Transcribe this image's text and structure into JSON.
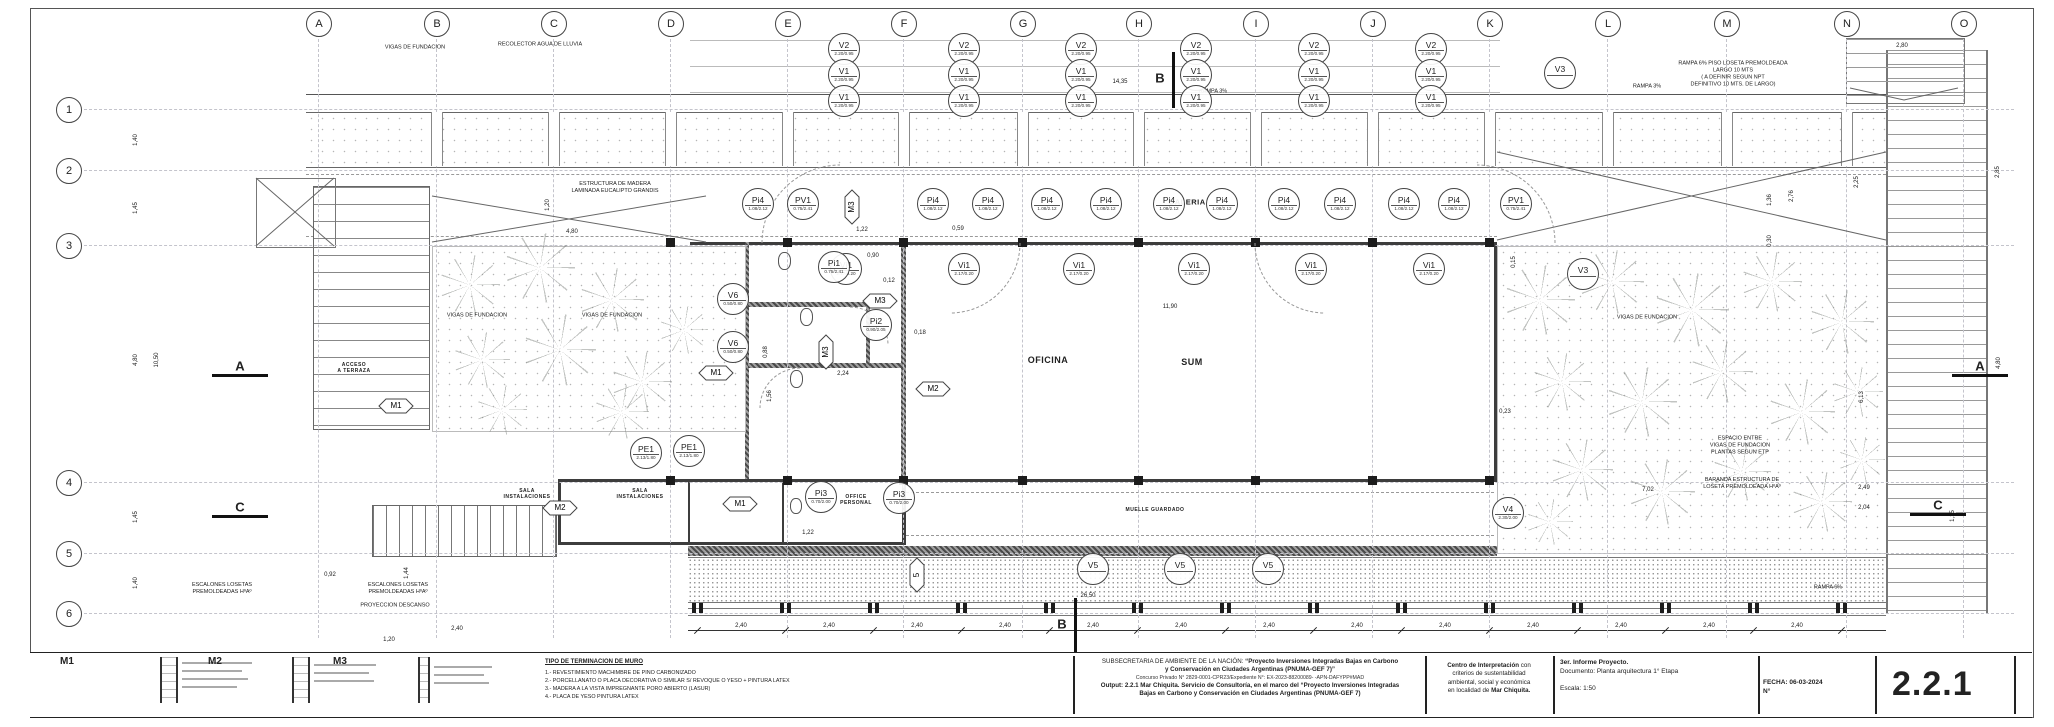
{
  "sheet": {
    "number": "2.2.1"
  },
  "grid": {
    "letters": [
      {
        "label": "A",
        "x": 318
      },
      {
        "label": "B",
        "x": 436
      },
      {
        "label": "C",
        "x": 553
      },
      {
        "label": "D",
        "x": 670
      },
      {
        "label": "E",
        "x": 787
      },
      {
        "label": "F",
        "x": 903
      },
      {
        "label": "G",
        "x": 1022
      },
      {
        "label": "H",
        "x": 1138
      },
      {
        "label": "I",
        "x": 1255
      },
      {
        "label": "J",
        "x": 1372
      },
      {
        "label": "K",
        "x": 1489
      },
      {
        "label": "L",
        "x": 1607
      },
      {
        "label": "M",
        "x": 1726
      },
      {
        "label": "N",
        "x": 1846
      },
      {
        "label": "O",
        "x": 1963
      }
    ],
    "numbers": [
      {
        "label": "1",
        "y": 109
      },
      {
        "label": "2",
        "y": 170
      },
      {
        "label": "3",
        "y": 245
      },
      {
        "label": "4",
        "y": 482
      },
      {
        "label": "5",
        "y": 553
      },
      {
        "label": "6",
        "y": 613
      }
    ]
  },
  "rooms": [
    {
      "label": "OFICINA",
      "x": 1048,
      "y": 360,
      "size": 9
    },
    {
      "label": "SUM",
      "x": 1192,
      "y": 362,
      "size": 9
    },
    {
      "label": "GALERIA",
      "x": 1187,
      "y": 202,
      "size": 7.5
    },
    {
      "label": "SALA\nINSTALACIONES",
      "x": 527,
      "y": 494,
      "size": 5
    },
    {
      "label": "SALA\nINSTALACIONES",
      "x": 640,
      "y": 494,
      "size": 5
    },
    {
      "label": "OFFICE\nPERSONAL",
      "x": 856,
      "y": 500,
      "size": 5
    },
    {
      "label": "ACCESO\nA TERRAZA",
      "x": 354,
      "y": 368,
      "size": 5
    },
    {
      "label": "MUELLE GUARDADO",
      "x": 1155,
      "y": 510,
      "size": 5
    }
  ],
  "annotations": [
    {
      "x": 415,
      "y": 48,
      "lines": [
        "VIGAS DE FUNDACION"
      ]
    },
    {
      "x": 540,
      "y": 45,
      "lines": [
        "RECOLECTOR AGUA DE LLUVIA"
      ]
    },
    {
      "x": 1213,
      "y": 92,
      "lines": [
        "RAMPA 3%"
      ]
    },
    {
      "x": 1647,
      "y": 87,
      "lines": [
        "RAMPA 3%"
      ]
    },
    {
      "x": 1733,
      "y": 74,
      "lines": [
        "RAMPA 6% PISO LOSETA PREMOLDEADA",
        "LARGO 10 MTS",
        "( A DEFINIR SEGUN NPT",
        "DEFINITIVO 10 MTS. DE LARGO)"
      ]
    },
    {
      "x": 615,
      "y": 188,
      "lines": [
        "ESTRUCTURA DE MADERA",
        "LAMINADA EUCALIPTO GRANDIS"
      ]
    },
    {
      "x": 477,
      "y": 316,
      "lines": [
        "VIGAS DE FUNDACION"
      ]
    },
    {
      "x": 612,
      "y": 316,
      "lines": [
        "VIGAS DE FUNDACION"
      ]
    },
    {
      "x": 1647,
      "y": 318,
      "lines": [
        "VIGAS DE FUNDACION"
      ]
    },
    {
      "x": 1740,
      "y": 446,
      "lines": [
        "ESPACIO ENTRE",
        "VIGAS DE FUNDACION",
        "PLANTAS SEGUN ETP"
      ]
    },
    {
      "x": 1742,
      "y": 484,
      "lines": [
        "BARANDA ESTRUCTURA DE",
        "LOSETA PREMOLDEADA HºAº"
      ]
    },
    {
      "x": 222,
      "y": 589,
      "lines": [
        "ESCALONES LOSETAS",
        "PREMOLDEADAS HºAº"
      ]
    },
    {
      "x": 398,
      "y": 589,
      "lines": [
        "ESCALONES LOSETAS",
        "PREMOLDEADAS HºAº"
      ]
    },
    {
      "x": 395,
      "y": 606,
      "lines": [
        "PROYECCION DESCANSO"
      ]
    },
    {
      "x": 1828,
      "y": 588,
      "lines": [
        "RAMPA 6%"
      ]
    }
  ],
  "dimensions": [
    {
      "text": "33,60",
      "x": 1137,
      "y": 30
    },
    {
      "text": "14,35",
      "x": 1120,
      "y": 82
    },
    {
      "text": "2,80",
      "x": 1902,
      "y": 46
    },
    {
      "text": "1,40",
      "x": 136,
      "y": 140,
      "rot": "v"
    },
    {
      "text": "1,45",
      "x": 136,
      "y": 208,
      "rot": "v"
    },
    {
      "text": "4,80",
      "x": 136,
      "y": 360,
      "rot": "v"
    },
    {
      "text": "10,50",
      "x": 157,
      "y": 360,
      "rot": "v"
    },
    {
      "text": "1,45",
      "x": 136,
      "y": 517,
      "rot": "v"
    },
    {
      "text": "1,40",
      "x": 136,
      "y": 583,
      "rot": "v"
    },
    {
      "text": "4,80",
      "x": 572,
      "y": 232
    },
    {
      "text": "1,20",
      "x": 548,
      "y": 205,
      "rot": "v"
    },
    {
      "text": "11,90",
      "x": 1170,
      "y": 307
    },
    {
      "text": "0,90",
      "x": 873,
      "y": 256
    },
    {
      "text": "0,12",
      "x": 889,
      "y": 281
    },
    {
      "text": "0,88",
      "x": 766,
      "y": 352,
      "rot": "v"
    },
    {
      "text": "1,56",
      "x": 770,
      "y": 396,
      "rot": "v"
    },
    {
      "text": "2,24",
      "x": 843,
      "y": 374
    },
    {
      "text": "0,18",
      "x": 920,
      "y": 333
    },
    {
      "text": "1,22",
      "x": 862,
      "y": 230
    },
    {
      "text": "0,59",
      "x": 958,
      "y": 229
    },
    {
      "text": "0,15",
      "x": 1514,
      "y": 262,
      "rot": "v"
    },
    {
      "text": "1,22",
      "x": 808,
      "y": 533
    },
    {
      "text": "2,25",
      "x": 1857,
      "y": 182,
      "rot": "v"
    },
    {
      "text": "2,85",
      "x": 1998,
      "y": 172,
      "rot": "v"
    },
    {
      "text": "1,36",
      "x": 1770,
      "y": 200,
      "rot": "v"
    },
    {
      "text": "2,76",
      "x": 1792,
      "y": 196,
      "rot": "v"
    },
    {
      "text": "0,30",
      "x": 1770,
      "y": 241,
      "rot": "v"
    },
    {
      "text": "6,13",
      "x": 1862,
      "y": 397,
      "rot": "v"
    },
    {
      "text": "4,80",
      "x": 1999,
      "y": 363,
      "rot": "v"
    },
    {
      "text": "7,02",
      "x": 1648,
      "y": 490
    },
    {
      "text": "2,49",
      "x": 1864,
      "y": 488
    },
    {
      "text": "2,04",
      "x": 1864,
      "y": 508
    },
    {
      "text": "1,15",
      "x": 1953,
      "y": 516,
      "rot": "v"
    },
    {
      "text": "0,23",
      "x": 1505,
      "y": 412
    },
    {
      "text": "26,50",
      "x": 1088,
      "y": 596
    },
    {
      "text": "0,92",
      "x": 330,
      "y": 575
    },
    {
      "text": "1,44",
      "x": 407,
      "y": 573,
      "rot": "v"
    },
    {
      "text": "2,40",
      "x": 457,
      "y": 629
    },
    {
      "text": "1,20",
      "x": 389,
      "y": 640
    }
  ],
  "chain": {
    "label": "2,40",
    "y": 626,
    "label_xs": [
      741,
      829,
      917,
      1005,
      1093,
      1181,
      1269,
      1357,
      1445,
      1533,
      1621,
      1709,
      1797
    ],
    "tick_xs": [
      697,
      785,
      873,
      961,
      1049,
      1137,
      1225,
      1313,
      1401,
      1489,
      1577,
      1665,
      1753,
      1841
    ]
  },
  "tags": [
    {
      "shape": "circle",
      "label": "V2",
      "value": "2.20/0.95",
      "x": 843,
      "y": 48
    },
    {
      "shape": "circle",
      "label": "V2",
      "value": "2.20/0.95",
      "x": 963,
      "y": 48
    },
    {
      "shape": "circle",
      "label": "V2",
      "value": "2.20/0.95",
      "x": 1080,
      "y": 48
    },
    {
      "shape": "circle",
      "label": "V2",
      "value": "2.20/0.95",
      "x": 1195,
      "y": 48
    },
    {
      "shape": "circle",
      "label": "V2",
      "value": "2.20/0.95",
      "x": 1313,
      "y": 48
    },
    {
      "shape": "circle",
      "label": "V2",
      "value": "2.20/0.95",
      "x": 1430,
      "y": 48
    },
    {
      "shape": "circle",
      "label": "V1",
      "value": "2.20/0.95",
      "x": 843,
      "y": 74
    },
    {
      "shape": "circle",
      "label": "V1",
      "value": "2.20/0.95",
      "x": 963,
      "y": 74
    },
    {
      "shape": "circle",
      "label": "V1",
      "value": "2.20/0.95",
      "x": 1080,
      "y": 74
    },
    {
      "shape": "circle",
      "label": "V1",
      "value": "2.20/0.95",
      "x": 1195,
      "y": 74
    },
    {
      "shape": "circle",
      "label": "V1",
      "value": "2.20/0.95",
      "x": 1313,
      "y": 74
    },
    {
      "shape": "circle",
      "label": "V1",
      "value": "2.20/0.95",
      "x": 1430,
      "y": 74
    },
    {
      "shape": "circle",
      "label": "V1",
      "value": "2.20/0.95",
      "x": 843,
      "y": 100
    },
    {
      "shape": "circle",
      "label": "V1",
      "value": "2.20/0.95",
      "x": 963,
      "y": 100
    },
    {
      "shape": "circle",
      "label": "V1",
      "value": "2.20/0.95",
      "x": 1080,
      "y": 100
    },
    {
      "shape": "circle",
      "label": "V1",
      "value": "2.20/0.95",
      "x": 1195,
      "y": 100
    },
    {
      "shape": "circle",
      "label": "V1",
      "value": "2.20/0.95",
      "x": 1313,
      "y": 100
    },
    {
      "shape": "circle",
      "label": "V1",
      "value": "2.20/0.95",
      "x": 1430,
      "y": 100
    },
    {
      "shape": "circle",
      "label": "Pi4",
      "value": "1.08/2.12",
      "x": 757,
      "y": 203
    },
    {
      "shape": "circle",
      "label": "Pi4",
      "value": "1.08/2.12",
      "x": 932,
      "y": 203
    },
    {
      "shape": "circle",
      "label": "Pi4",
      "value": "1.08/2.12",
      "x": 987,
      "y": 203
    },
    {
      "shape": "circle",
      "label": "Pi4",
      "value": "1.08/2.12",
      "x": 1046,
      "y": 203
    },
    {
      "shape": "circle",
      "label": "Pi4",
      "value": "1.08/2.12",
      "x": 1105,
      "y": 203
    },
    {
      "shape": "circle",
      "label": "Pi4",
      "value": "1.08/2.12",
      "x": 1168,
      "y": 203
    },
    {
      "shape": "circle",
      "label": "Pi4",
      "value": "1.08/2.12",
      "x": 1221,
      "y": 203
    },
    {
      "shape": "circle",
      "label": "Pi4",
      "value": "1.08/2.12",
      "x": 1283,
      "y": 203
    },
    {
      "shape": "circle",
      "label": "Pi4",
      "value": "1.08/2.12",
      "x": 1339,
      "y": 203
    },
    {
      "shape": "circle",
      "label": "Pi4",
      "value": "1.08/2.12",
      "x": 1403,
      "y": 203
    },
    {
      "shape": "circle",
      "label": "Pi4",
      "value": "1.08/2.12",
      "x": 1453,
      "y": 203
    },
    {
      "shape": "circle",
      "label": "Vi1",
      "value": "2.17/0.20",
      "x": 845,
      "y": 268
    },
    {
      "shape": "circle",
      "label": "Vi1",
      "value": "2.17/0.20",
      "x": 963,
      "y": 268
    },
    {
      "shape": "circle",
      "label": "Vi1",
      "value": "2.17/0.20",
      "x": 1078,
      "y": 268
    },
    {
      "shape": "circle",
      "label": "Vi1",
      "value": "2.17/0.20",
      "x": 1193,
      "y": 268
    },
    {
      "shape": "circle",
      "label": "Vi1",
      "value": "2.17/0.20",
      "x": 1310,
      "y": 268
    },
    {
      "shape": "circle",
      "label": "Vi1",
      "value": "2.17/0.20",
      "x": 1428,
      "y": 268
    },
    {
      "shape": "circle",
      "label": "PV1",
      "value": "0.75/2.41",
      "x": 802,
      "y": 203
    },
    {
      "shape": "circle",
      "label": "PV1",
      "value": "0.75/2.41",
      "x": 1515,
      "y": 203
    },
    {
      "shape": "circle",
      "label": "Pi1",
      "value": "0.75/2.41",
      "x": 833,
      "y": 266
    },
    {
      "shape": "circle",
      "label": "Pi2",
      "value": "0.90/2.05",
      "x": 875,
      "y": 324
    },
    {
      "shape": "circle",
      "label": "Pi3",
      "value": "0.70/2.00",
      "x": 820,
      "y": 496
    },
    {
      "shape": "circle",
      "label": "Pi3",
      "value": "0.70/2.00",
      "x": 898,
      "y": 497
    },
    {
      "shape": "circle",
      "label": "V6",
      "value": "0.50/0.80",
      "x": 732,
      "y": 298
    },
    {
      "shape": "circle",
      "label": "V6",
      "value": "0.50/0.80",
      "x": 732,
      "y": 346
    },
    {
      "shape": "circle",
      "label": "PE1",
      "value": "2.13/1.80",
      "x": 645,
      "y": 452
    },
    {
      "shape": "circle",
      "label": "PE1",
      "value": "2.13/1.80",
      "x": 688,
      "y": 450
    },
    {
      "shape": "circle",
      "label": "V3",
      "value": "",
      "x": 1559,
      "y": 72
    },
    {
      "shape": "circle",
      "label": "V3",
      "value": "",
      "x": 1582,
      "y": 273
    },
    {
      "shape": "circle",
      "label": "V4",
      "value": "2.30/2.00",
      "x": 1507,
      "y": 512
    },
    {
      "shape": "circle",
      "label": "V5",
      "value": "",
      "x": 1092,
      "y": 568
    },
    {
      "shape": "circle",
      "label": "V5",
      "value": "",
      "x": 1179,
      "y": 568
    },
    {
      "shape": "circle",
      "label": "V5",
      "value": "",
      "x": 1267,
      "y": 568
    },
    {
      "shape": "hex",
      "label": "M1",
      "x": 716,
      "y": 373
    },
    {
      "shape": "hex",
      "label": "M2",
      "x": 933,
      "y": 389
    },
    {
      "shape": "hex",
      "label": "M3",
      "x": 880,
      "y": 301
    },
    {
      "shape": "hex",
      "label": "M1",
      "x": 740,
      "y": 504
    },
    {
      "shape": "hex",
      "label": "M2",
      "x": 560,
      "y": 508
    },
    {
      "shape": "hex",
      "label": "M1",
      "x": 396,
      "y": 406
    },
    {
      "shape": "hexv",
      "label": "M3",
      "x": 852,
      "y": 207
    },
    {
      "shape": "hexv",
      "label": "M3",
      "x": 826,
      "y": 352
    },
    {
      "shape": "hexv",
      "label": "5",
      "x": 917,
      "y": 575
    }
  ],
  "sections": [
    {
      "label": "A",
      "x": 240,
      "y": 366,
      "orient": "h"
    },
    {
      "label": "C",
      "x": 240,
      "y": 507,
      "orient": "h"
    },
    {
      "label": "A",
      "x": 1980,
      "y": 366,
      "orient": "h"
    },
    {
      "label": "C",
      "x": 1938,
      "y": 505,
      "orient": "h"
    },
    {
      "label": "B",
      "x": 1160,
      "y": 78,
      "orient": "v"
    },
    {
      "label": "B",
      "x": 1062,
      "y": 624,
      "orient": "v"
    }
  ],
  "wall_details": [
    {
      "label": "M1"
    },
    {
      "label": "M2"
    },
    {
      "label": "M3"
    }
  ],
  "legend": {
    "title": "TIPO DE TERMINACION DE MURO",
    "l1": "1.- REVESTIMIENTO MACHIMBRE DE PINO CARBONIZADO",
    "l2": "2.- PORCELLANATO O PLACA DECORATIVA O SIMILAR S/ REVOQUE O YESO + PINTURA LATEX",
    "l3": "3.- MADERA A LA VISTA IMPREGNANTE PORO ABIERTO (LASUR)",
    "l4": "4.- PLACA DE YESO PINTURA LATEX"
  },
  "title_block": {
    "org_prefix": "SUBSECRETARIA DE AMBIENTE DE LA NACIÓN: ",
    "org_bold1": "“Proyecto Inversiones Integradas Bajas en Carbono",
    "org_bold2": "y Conservación en Ciudades Argentinas (PNUMA-GEF 7)”",
    "concurso": "Concurso Privado N° 2829-0001-CPR23/Expediente N°: EX-2023-88200089- -APN-DAFYPP#MAD",
    "output1": "Output: 2.2.1 Mar Chiquita. Servicio de Consultoría, en el marco del “Proyecto Inversiones Integradas",
    "output2": "Bajas en Carbono y Conservación en Ciudades Argentinas (PNUMA-GEF 7)",
    "centro_b1": "Centro de Interpretación",
    "centro_r1": " con",
    "centro_l2": "criterios de sustentabilidad",
    "centro_l3": "ambiental, social y económica",
    "centro_l4a": "en localidad de ",
    "centro_b4": "Mar Chiquita.",
    "informe": "3er. Informe Proyecto.",
    "documento": "Documento: Planta arquitectura 1° Etapa",
    "escala": "Escala: 1:50",
    "fecha": "FECHA: 06-03-2024",
    "nro": "N°"
  }
}
